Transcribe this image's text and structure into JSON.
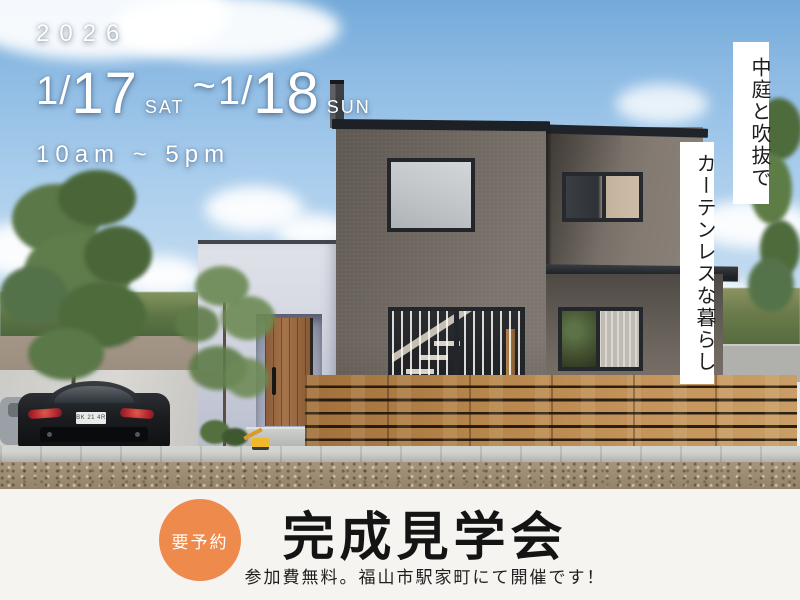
{
  "overlay": {
    "year": "2026",
    "schedule": {
      "month_1": "1/",
      "day_1": "17",
      "weekday_1": "SAT",
      "separator": "~",
      "month_2": "1/",
      "day_2": "18",
      "weekday_2": "SUN"
    },
    "hours": "10am ~ 5pm",
    "vertical_copy": {
      "line_1": "中庭と吹抜で",
      "line_2": "カーテンレスな暮らし"
    }
  },
  "car": {
    "license_plate": "BK 21 4R"
  },
  "band": {
    "badge_label": "要予約",
    "title": "完成見学会",
    "subtitle": "参加費無料。福山市駅家町にて開催です！"
  },
  "colors": {
    "accent_orange": "#ef8a4d",
    "band_background": "#f6f4f1",
    "headline_text": "#141414",
    "overlay_text": "#ffffff",
    "fence_wood": "#b5854c",
    "dark_wall": "#746d66",
    "light_wall": "#d8dae3",
    "sky": "#8fbce4"
  }
}
